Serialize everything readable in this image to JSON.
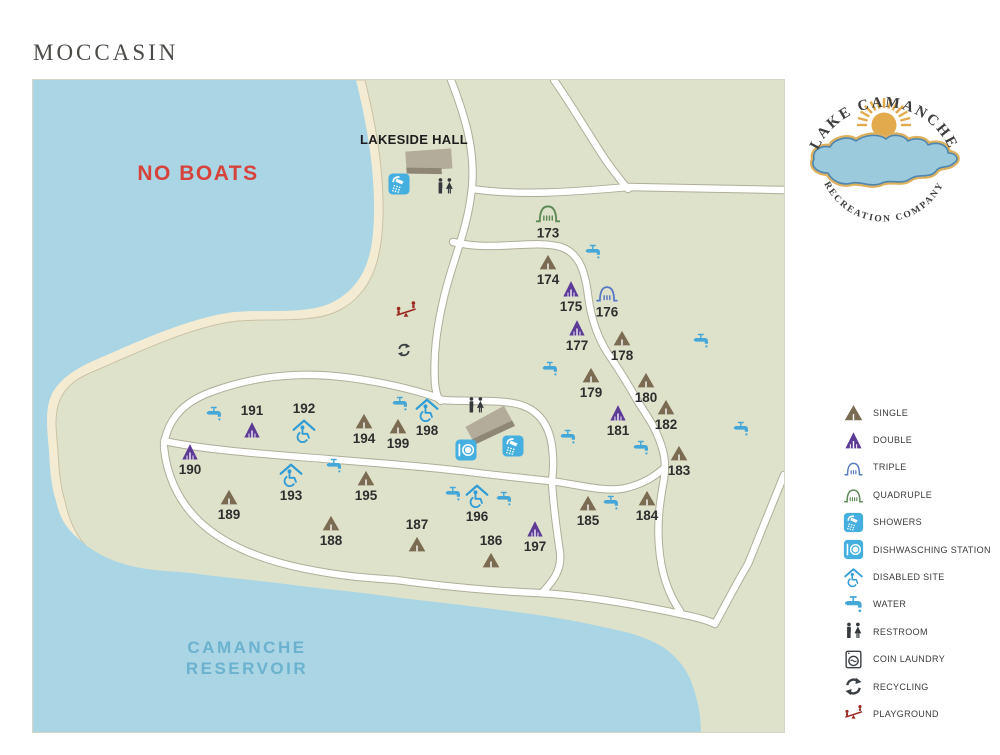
{
  "title": "MOCCASIN",
  "map": {
    "no_boats_label": "NO BOATS",
    "reservoir_label": [
      "CAMANCHE",
      "RESERVOIR"
    ],
    "lakeside_hall_label": "LAKESIDE HALL",
    "colors": {
      "water": "#a9d5e5",
      "sand": "#f4ebd3",
      "land": "#dfe2cb",
      "road": "#ffffff",
      "road_edge": "#a8a491",
      "no_boats_text": "#d7423a",
      "reservoir_text": "#6cb2cf",
      "single_site": "#7b6b52",
      "double_site": "#5c3a96",
      "triple_site": "#5578c2",
      "quadruple_site": "#5d8a57",
      "facility_blue": "#45b0e0",
      "disabled_blue": "#2f9cd6",
      "restroom_dark": "#35393c",
      "playground_red": "#9b2a22"
    },
    "sites": [
      {
        "number": "173",
        "type": "quadruple",
        "x": 547,
        "y": 211,
        "label_pos": "below"
      },
      {
        "number": "174",
        "type": "single",
        "x": 547,
        "y": 261,
        "label_pos": "below"
      },
      {
        "number": "175",
        "type": "double",
        "x": 570,
        "y": 288,
        "label_pos": "below"
      },
      {
        "number": "176",
        "type": "triple",
        "x": 606,
        "y": 291,
        "label_pos": "below"
      },
      {
        "number": "177",
        "type": "double",
        "x": 576,
        "y": 327,
        "label_pos": "below"
      },
      {
        "number": "178",
        "type": "single",
        "x": 621,
        "y": 337,
        "label_pos": "below"
      },
      {
        "number": "179",
        "type": "single",
        "x": 590,
        "y": 374,
        "label_pos": "below"
      },
      {
        "number": "180",
        "type": "single",
        "x": 645,
        "y": 379,
        "label_pos": "below"
      },
      {
        "number": "181",
        "type": "double",
        "x": 617,
        "y": 412,
        "label_pos": "below"
      },
      {
        "number": "182",
        "type": "single",
        "x": 665,
        "y": 406,
        "label_pos": "below"
      },
      {
        "number": "183",
        "type": "single",
        "x": 678,
        "y": 452,
        "label_pos": "below"
      },
      {
        "number": "184",
        "type": "single",
        "x": 646,
        "y": 497,
        "label_pos": "below"
      },
      {
        "number": "185",
        "type": "single",
        "x": 587,
        "y": 502,
        "label_pos": "below"
      },
      {
        "number": "186",
        "type": "single",
        "x": 490,
        "y": 559,
        "label_pos": "above"
      },
      {
        "number": "187",
        "type": "single",
        "x": 416,
        "y": 543,
        "label_pos": "above"
      },
      {
        "number": "188",
        "type": "single",
        "x": 330,
        "y": 522,
        "label_pos": "below"
      },
      {
        "number": "189",
        "type": "single",
        "x": 228,
        "y": 496,
        "label_pos": "below"
      },
      {
        "number": "190",
        "type": "double",
        "x": 189,
        "y": 451,
        "label_pos": "below"
      },
      {
        "number": "191",
        "type": "double",
        "x": 251,
        "y": 429,
        "label_pos": "above"
      },
      {
        "number": "192",
        "type": "disabled",
        "x": 303,
        "y": 430,
        "label_pos": "above"
      },
      {
        "number": "193",
        "type": "disabled",
        "x": 290,
        "y": 474,
        "label_pos": "below"
      },
      {
        "number": "194",
        "type": "single",
        "x": 363,
        "y": 420,
        "label_pos": "below"
      },
      {
        "number": "195",
        "type": "single",
        "x": 365,
        "y": 477,
        "label_pos": "below"
      },
      {
        "number": "196",
        "type": "disabled",
        "x": 476,
        "y": 495,
        "label_pos": "below"
      },
      {
        "number": "197",
        "type": "double",
        "x": 534,
        "y": 528,
        "label_pos": "below"
      },
      {
        "number": "198",
        "type": "disabled",
        "x": 426,
        "y": 409,
        "label_pos": "below"
      },
      {
        "number": "199",
        "type": "single",
        "x": 397,
        "y": 425,
        "label_pos": "below"
      }
    ],
    "facilities": [
      {
        "type": "shower",
        "x": 398,
        "y": 183
      },
      {
        "type": "restroom",
        "x": 444,
        "y": 186
      },
      {
        "type": "playground",
        "x": 405,
        "y": 310
      },
      {
        "type": "recycling",
        "x": 403,
        "y": 349
      },
      {
        "type": "restroom",
        "x": 475,
        "y": 405
      },
      {
        "type": "dishwashing",
        "x": 465,
        "y": 449
      },
      {
        "type": "shower",
        "x": 512,
        "y": 445
      }
    ],
    "water_faucets": [
      {
        "x": 592,
        "y": 251
      },
      {
        "x": 700,
        "y": 340
      },
      {
        "x": 549,
        "y": 368
      },
      {
        "x": 213,
        "y": 413
      },
      {
        "x": 399,
        "y": 403
      },
      {
        "x": 567,
        "y": 436
      },
      {
        "x": 640,
        "y": 447
      },
      {
        "x": 740,
        "y": 428
      },
      {
        "x": 333,
        "y": 465
      },
      {
        "x": 452,
        "y": 493
      },
      {
        "x": 503,
        "y": 498
      },
      {
        "x": 610,
        "y": 502
      }
    ]
  },
  "legend": {
    "items": [
      {
        "icon": "single-tent-icon",
        "sym": "single",
        "label": "SINGLE"
      },
      {
        "icon": "double-tent-icon",
        "sym": "double",
        "label": "DOUBLE"
      },
      {
        "icon": "triple-site-icon",
        "sym": "triple",
        "label": "TRIPLE"
      },
      {
        "icon": "quadruple-site-icon",
        "sym": "quadruple",
        "label": "QUADRUPLE"
      },
      {
        "icon": "showers-icon",
        "sym": "shower",
        "label": "SHOWERS"
      },
      {
        "icon": "dishwashing-station-icon",
        "sym": "dishwash",
        "label": "DISHWASCHING STATION"
      },
      {
        "icon": "disabled-site-icon",
        "sym": "disabled",
        "label": "DISABLED SITE"
      },
      {
        "icon": "water-faucet-icon",
        "sym": "faucet",
        "label": "WATER"
      },
      {
        "icon": "restroom-icon",
        "sym": "restroom",
        "label": "RESTROOM"
      },
      {
        "icon": "coin-laundry-icon",
        "sym": "laundry",
        "label": "COIN LAUNDRY"
      },
      {
        "icon": "recycling-icon",
        "sym": "recycle",
        "label": "RECYCLING"
      },
      {
        "icon": "playground-icon",
        "sym": "playground",
        "label": "PLAYGROUND"
      }
    ]
  },
  "logo": {
    "top_text": "LAKE CAMANCHE",
    "bottom_text": "RECREATION COMPANY"
  }
}
